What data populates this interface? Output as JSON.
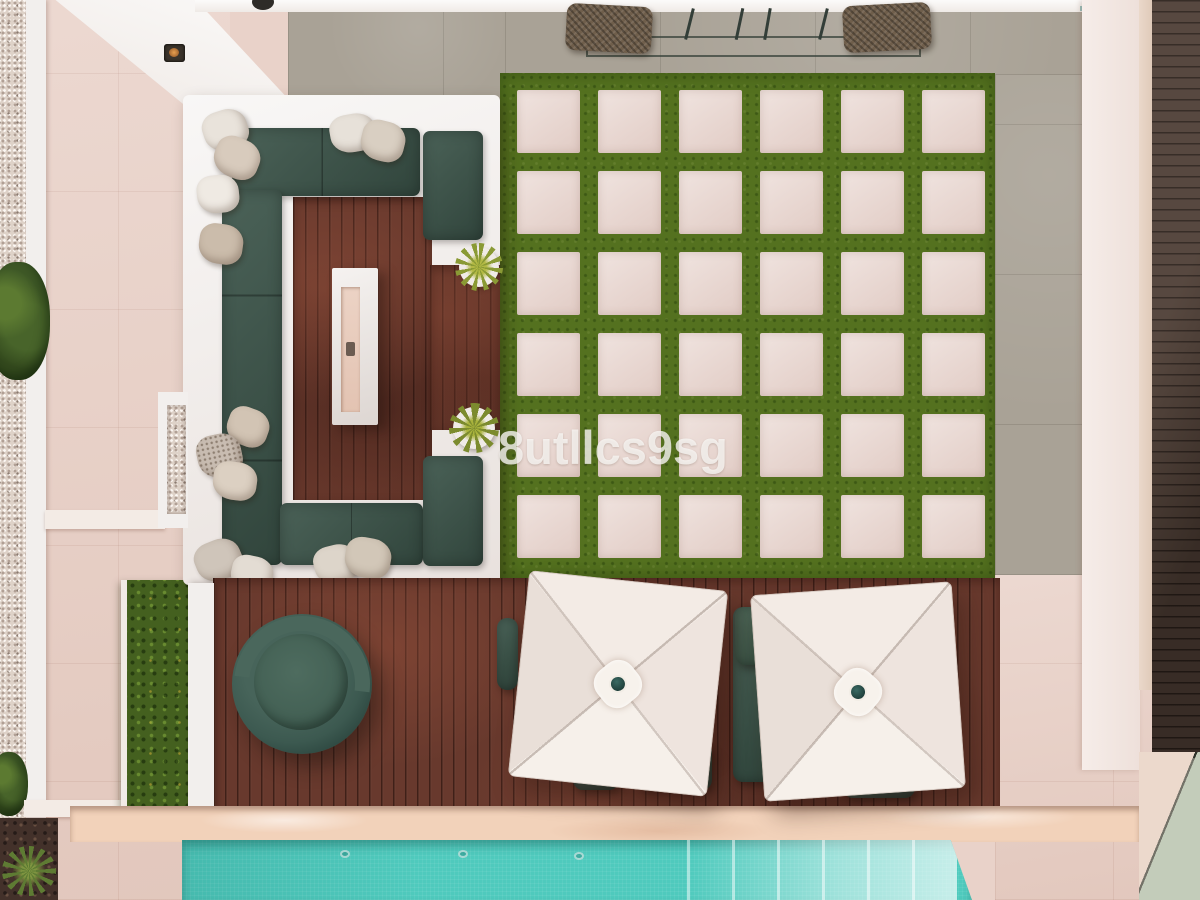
{
  "watermark": {
    "text": "8utllcs9sg"
  },
  "paver_grid": {
    "rows": 6,
    "cols": 6
  },
  "palette": {
    "pool": "#4fcabd",
    "pool-steps": "#a9e2d6",
    "grass": "#54711f",
    "deck": "#68392d",
    "cushion": "#3d564b",
    "umbrella": "#f2eae4",
    "coping": "#f2d2ba",
    "paver": "#ead9d3",
    "walkway": "#e9d2c9"
  }
}
